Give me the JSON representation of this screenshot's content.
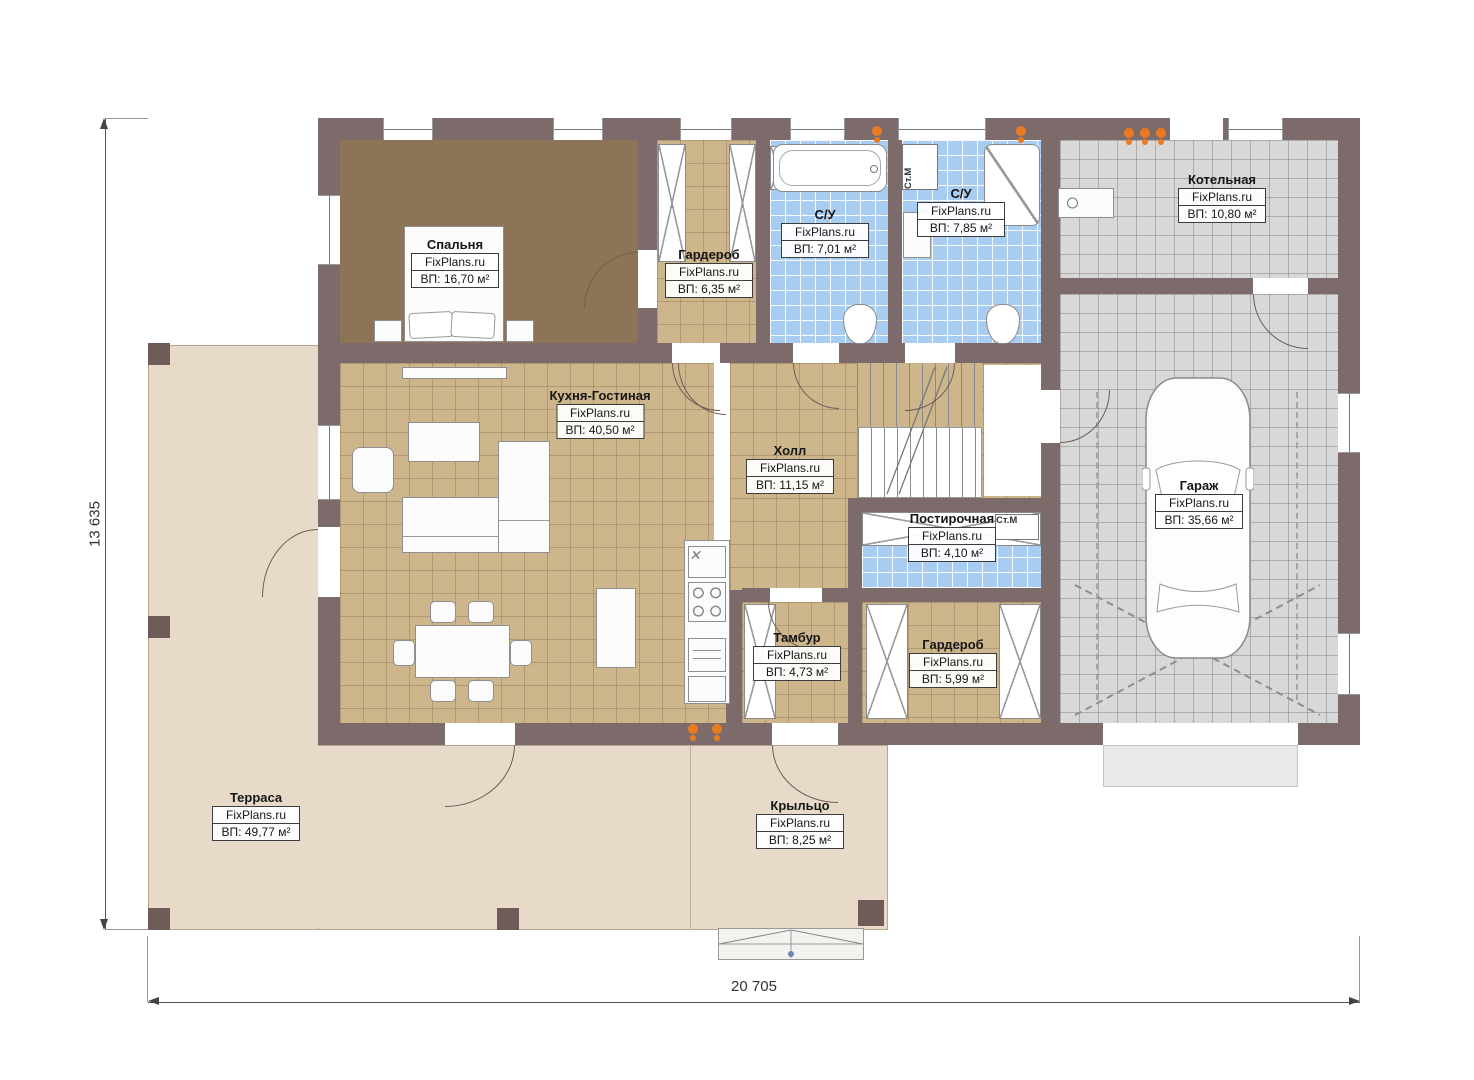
{
  "plan": {
    "watermark": "FixPlans.ru",
    "dimensions": {
      "height_label": "13 635",
      "width_label": "20 705"
    },
    "annotations": {
      "washing_machine": "Ст.М"
    },
    "rooms": [
      {
        "id": "bedroom",
        "name": "Спальня",
        "area": "ВП: 16,70 м²"
      },
      {
        "id": "wardrobe1",
        "name": "Гардероб",
        "area": "ВП: 6,35 м²"
      },
      {
        "id": "bath1",
        "name": "С/У",
        "area": "ВП: 7,01 м²"
      },
      {
        "id": "bath2",
        "name": "С/У",
        "area": "ВП: 7,85 м²"
      },
      {
        "id": "boiler",
        "name": "Котельная",
        "area": "ВП: 10,80 м²"
      },
      {
        "id": "kitchen",
        "name": "Кухня-Гостиная",
        "area": "ВП: 40,50 м²"
      },
      {
        "id": "hall",
        "name": "Холл",
        "area": "ВП: 11,15 м²"
      },
      {
        "id": "garage",
        "name": "Гараж",
        "area": "ВП: 35,66 м²"
      },
      {
        "id": "laundry",
        "name": "Постирочная",
        "area": "ВП: 4,10 м²"
      },
      {
        "id": "tambour",
        "name": "Тамбур",
        "area": "ВП: 4,73 м²"
      },
      {
        "id": "wardrobe2",
        "name": "Гардероб",
        "area": "ВП: 5,99 м²"
      },
      {
        "id": "terrace",
        "name": "Терраса",
        "area": "ВП: 49,77 м²"
      },
      {
        "id": "porch",
        "name": "Крыльцо",
        "area": "ВП: 8,25 м²"
      }
    ]
  }
}
